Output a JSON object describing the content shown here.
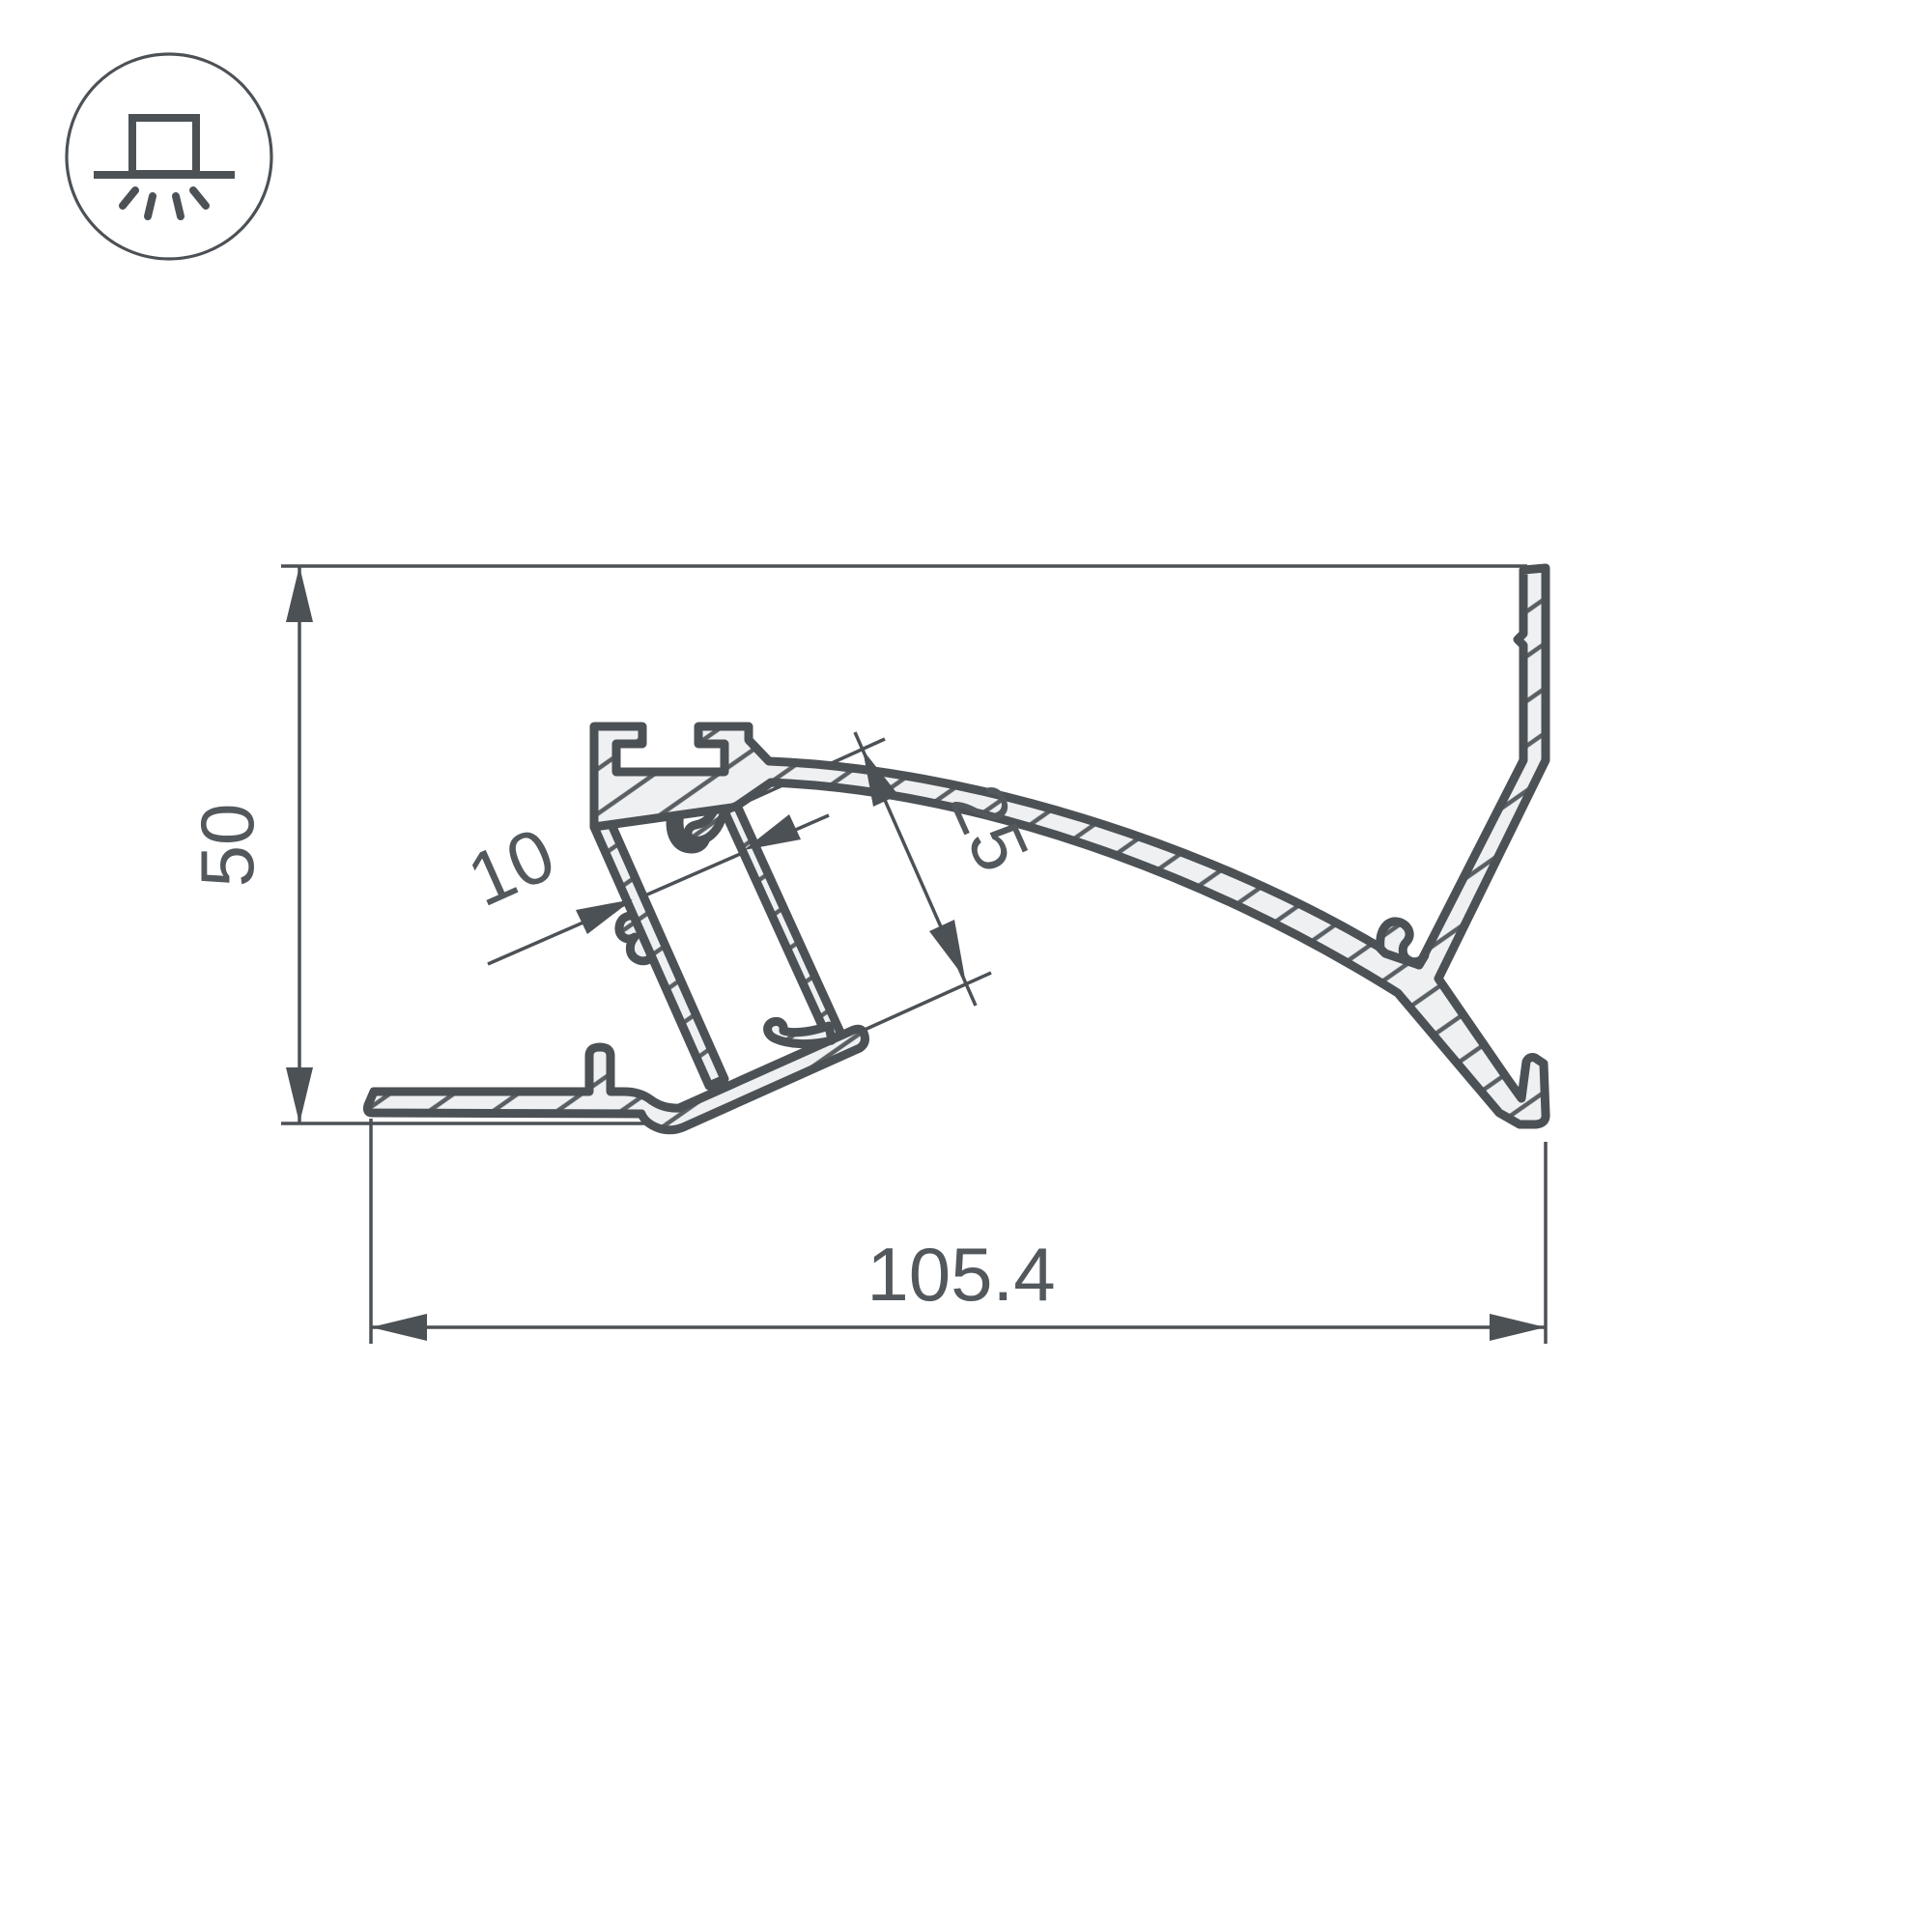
{
  "drawing": {
    "title": "led-profile-cross-section",
    "icon": {
      "name": "surface-mounted-light-icon"
    },
    "dimensions": {
      "height": "50",
      "width": "105.4",
      "depth": "25",
      "slot": "10"
    },
    "units": "mm",
    "colors": {
      "line": "#4c5156",
      "fill": "#eef0f1",
      "hatch": "#5a5f64",
      "text": "#53585d",
      "background": "#ffffff"
    }
  }
}
